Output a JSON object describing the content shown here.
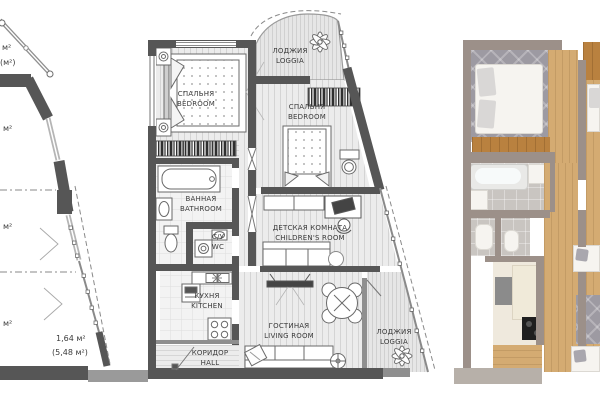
{
  "left_panel": {
    "partial_area_labels": [
      "м²",
      "(м²)",
      "м²",
      "м²",
      "м²"
    ],
    "loggia_area": "1,64 м²",
    "loggia_area_total": "(5,48 м²)"
  },
  "main_plan": {
    "rooms": {
      "bedroom1": {
        "ru": "СПАЛЬНЯ",
        "en": "BEDROOM"
      },
      "loggia_top": {
        "ru": "ЛОДЖИЯ",
        "en": "LOGGIA"
      },
      "bedroom2": {
        "ru": "СПАЛЬНЯ",
        "en": "BEDROOM"
      },
      "bathroom": {
        "ru": "ВАННАЯ",
        "en": "BATHROOM"
      },
      "wc": {
        "ru": "С/У",
        "en": "WC"
      },
      "children": {
        "ru": "ДЕТСКАЯ КОМНАТА",
        "en": "CHILDREN'S ROOM"
      },
      "kitchen": {
        "ru": "КУХНЯ",
        "en": "KITCHEN"
      },
      "living": {
        "ru": "ГОСТИНАЯ",
        "en": "LIVING ROOM"
      },
      "hall": {
        "ru": "КОРИДОР",
        "en": "HALL"
      },
      "loggia_bottom": {
        "ru": "ЛОДЖИЯ",
        "en": "LOGGIA"
      }
    },
    "icons": [
      "plant-icon-top-loggia",
      "plant-icon-bottom-loggia"
    ]
  },
  "render_3d": {
    "description_icons": [
      "bed",
      "rug",
      "dresser",
      "bathtub",
      "sink",
      "toilet",
      "fridge",
      "counter",
      "cooktop",
      "sofa"
    ],
    "colors": {
      "wall": "#9c9089",
      "wood_floor": "#d4ab72",
      "tile_floor": "#c9c5c1",
      "rug": "#9d9aa2",
      "accent_wood": "#b9813f",
      "furniture_white": "#f6f4f0"
    }
  },
  "plan_colors": {
    "wall_dark": "#565656",
    "wall_mid": "#8f8f8f",
    "floor_light": "#ebebeb",
    "text": "#3b3b3b"
  }
}
